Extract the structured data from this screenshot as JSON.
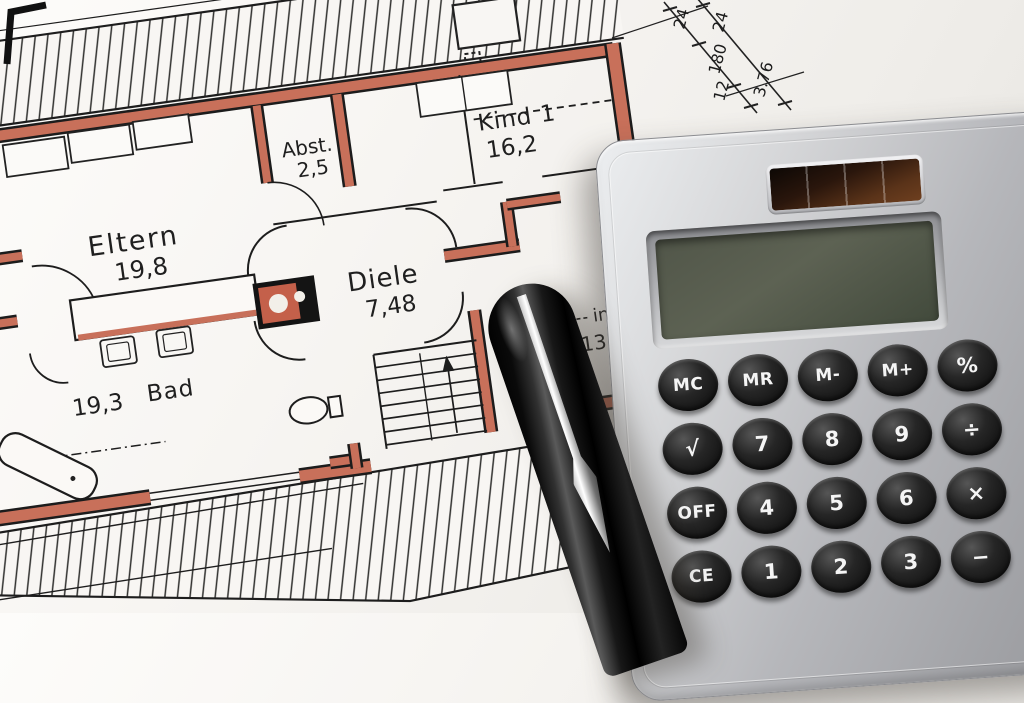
{
  "floorplan": {
    "rooms": [
      {
        "name": "Eltern",
        "area": "19,8"
      },
      {
        "name": "Abst.",
        "area": "2,5"
      },
      {
        "name": "Kind 1",
        "area": "16,2"
      },
      {
        "name": "Diele",
        "area": "7,48"
      },
      {
        "name": "Bad",
        "area": "19,3"
      }
    ],
    "partial_label": {
      "line1": "in",
      "line2": "13,"
    },
    "dimensions": {
      "d1": "24",
      "d2": "24",
      "d3": "180",
      "d4": "12",
      "d5": "3.76"
    },
    "wall_color": "#c8705a",
    "paper_color": "#f6f4f0"
  },
  "calculator": {
    "display_value": "",
    "buttons": [
      [
        "MC",
        "MR",
        "M-",
        "M+",
        "%"
      ],
      [
        "√",
        "7",
        "8",
        "9",
        "÷"
      ],
      [
        "OFF",
        "4",
        "5",
        "6",
        "×"
      ],
      [
        "CE",
        "1",
        "2",
        "3",
        "−"
      ]
    ],
    "body_color": "#b7b8bc",
    "button_color": "#141414",
    "display_color": "#4d5244",
    "solar_color": "#3a2012"
  },
  "pen": {
    "body_color": "#0b0b0b",
    "clip_color": "#d9d9d9"
  }
}
